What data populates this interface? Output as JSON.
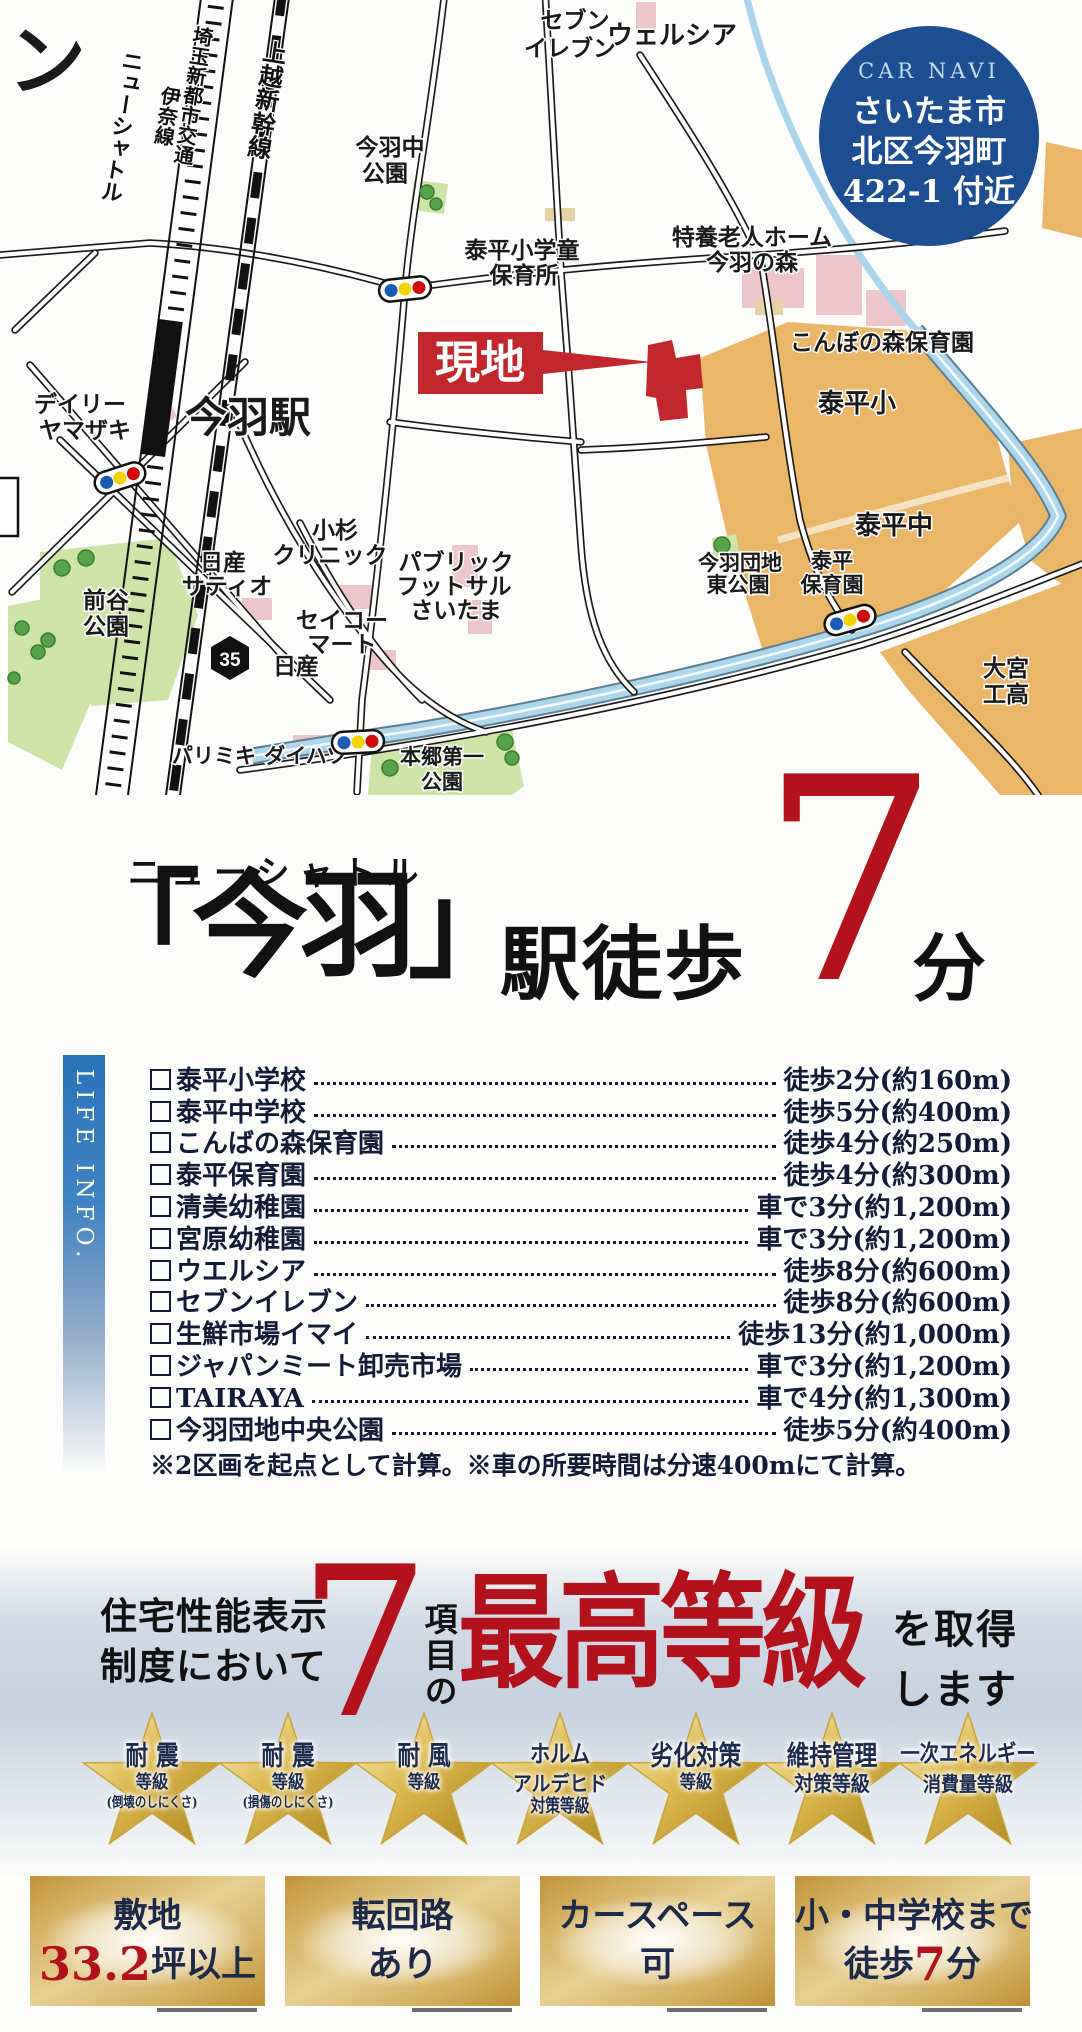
{
  "colors": {
    "accent_red": "#b3121c",
    "navy_circle": "#1c4e91",
    "text_navy": "#1e2a4a",
    "gold": "#d9b768",
    "orange_zone": "#eab667",
    "park_green": "#cde3a8",
    "river_blue": "#a9d4e9"
  },
  "map": {
    "corner_char": "ン",
    "site_label": "現地",
    "rail_labels": {
      "new_shuttle": "ニューシャトル",
      "ina": "伊奈線",
      "saitama": "埼玉新都市交通",
      "joetsu": "上越新幹線"
    },
    "places": {
      "seven": [
        "セブン",
        "イレブン"
      ],
      "welcia": "ウェルシア",
      "imbanaka": [
        "今羽中",
        "公園"
      ],
      "gakudo": [
        "泰平小学童",
        "保育所"
      ],
      "tokuyo": [
        "特養老人ホーム",
        "今羽の森"
      ],
      "konbo": "こんぼの森保育園",
      "taihei_sho": "泰平小",
      "taihei_chu": "泰平中",
      "station": "今羽駅",
      "daily": [
        "デイリー",
        "ヤマザキ"
      ],
      "kosugi": [
        "小杉",
        "クリニック"
      ],
      "satio": [
        "日産",
        "サティオ"
      ],
      "futsal": [
        "パブリック",
        "フットサル",
        "さいたま"
      ],
      "seiko": [
        "セイコー",
        "マート"
      ],
      "nissan": "日産",
      "route35": "35",
      "maeya": [
        "前谷",
        "公園"
      ],
      "parismiki": "パリミキ",
      "daihatsu": "ダイハツ",
      "hongo": [
        "本郷第一",
        "公園"
      ],
      "danchi": [
        "今羽団地",
        "東公園"
      ],
      "taihei_hoiku": [
        "泰平",
        "保育園"
      ],
      "omiya": [
        "大宮",
        "工高"
      ]
    },
    "car_navi": {
      "title": "CAR NAVI",
      "lines": [
        "さいたま市",
        "北区今羽町",
        "422-1 付近"
      ]
    }
  },
  "headline": {
    "small": "ニューシャトル",
    "station": "「今羽」",
    "suffix": "駅徒歩",
    "number": "7",
    "unit": "分"
  },
  "life": {
    "sidebar": "LIFE INFO.",
    "items": [
      {
        "name": "泰平小学校",
        "value": "徒歩2分(約160m)"
      },
      {
        "name": "泰平中学校",
        "value": "徒歩5分(約400m)"
      },
      {
        "name": "こんばの森保育園",
        "value": "徒歩4分(約250m)"
      },
      {
        "name": "泰平保育園",
        "value": "徒歩4分(約300m)"
      },
      {
        "name": "清美幼稚園",
        "value": "車で3分(約1,200m)"
      },
      {
        "name": "宮原幼稚園",
        "value": "車で3分(約1,200m)"
      },
      {
        "name": "ウエルシア",
        "value": "徒歩8分(約600m)"
      },
      {
        "name": "セブンイレブン",
        "value": "徒歩8分(約600m)"
      },
      {
        "name": "生鮮市場イマイ",
        "value": "徒歩13分(約1,000m)"
      },
      {
        "name": "ジャパンミート卸売市場",
        "value": "車で3分(約1,200m)"
      },
      {
        "name": "TAIRAYA",
        "value": "車で4分(約1,300m)"
      },
      {
        "name": "今羽団地中央公園",
        "value": "徒歩5分(約400m)"
      }
    ],
    "note": "※2区画を起点として計算。※車の所要時間は分速400mにて計算。"
  },
  "grade": {
    "l1": "住宅性能表示",
    "l2": "制度において",
    "number": "7",
    "middle": "項目の",
    "big": "最高等級",
    "r1": "を取得",
    "r2": "します"
  },
  "stars": [
    {
      "l1": "耐 震",
      "l2": "等級",
      "l3": "(倒壊のしにくさ)"
    },
    {
      "l1": "耐 震",
      "l2": "等級",
      "l3": "(損傷のしにくさ)"
    },
    {
      "l1": "耐 風",
      "l2": "等級",
      "l3": ""
    },
    {
      "l1": "ホルム",
      "l2": "アルデヒド",
      "l3": "対策等級"
    },
    {
      "l1": "劣化対策",
      "l2": "等級",
      "l3": ""
    },
    {
      "l1": "維持管理",
      "l2": "対策等級",
      "l3": ""
    },
    {
      "l1": "一次エネルギー",
      "l2": "消費量等級",
      "l3": ""
    }
  ],
  "badges": [
    {
      "top": "敷地",
      "pre": "",
      "red": "33.2",
      "post": "坪以上"
    },
    {
      "top": "転回路",
      "pre": "あり",
      "red": "",
      "post": ""
    },
    {
      "top": "カースペース",
      "pre": "可",
      "red": "",
      "post": ""
    },
    {
      "top": "小・中学校まで",
      "pre": "徒歩",
      "red": "7",
      "post": "分"
    }
  ]
}
